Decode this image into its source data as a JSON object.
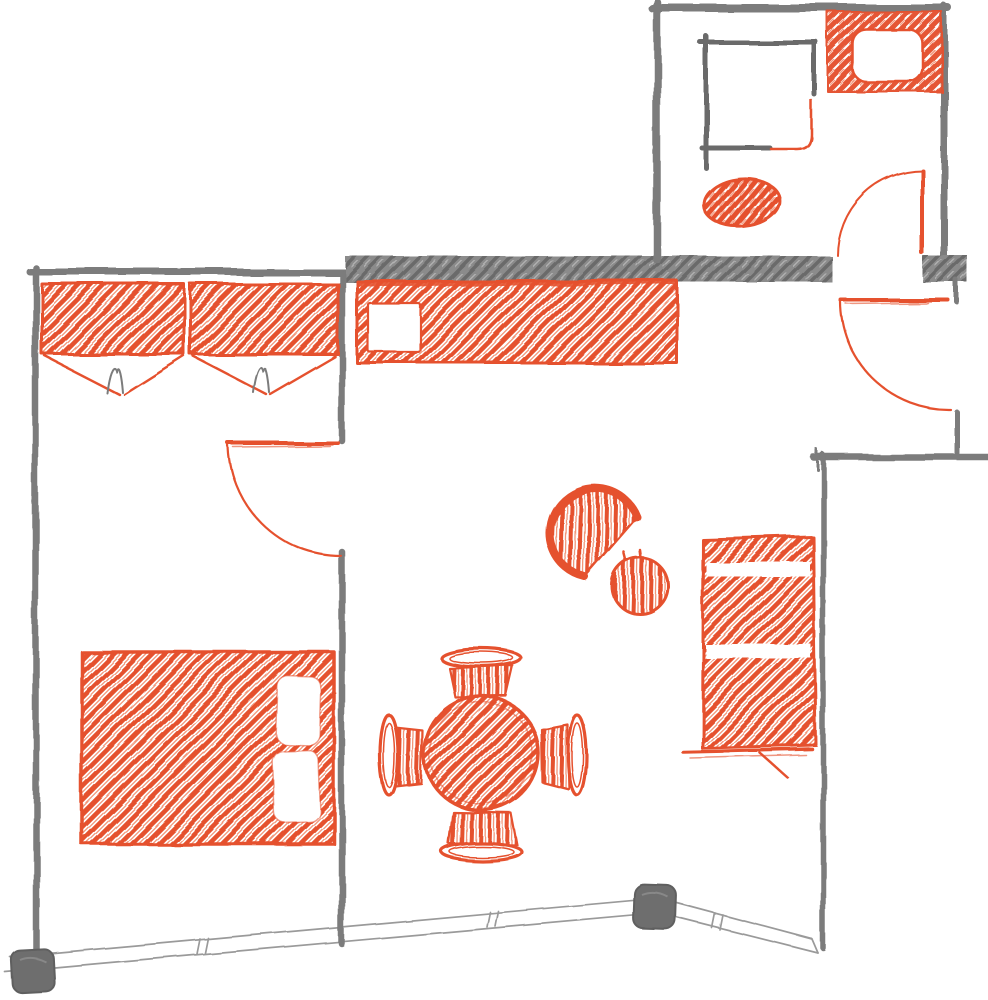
{
  "meta": {
    "title": "Hand-drawn apartment floor plan sketch",
    "style": "sketch, gray walls with orange furniture"
  },
  "palette": {
    "orange": "#e5512e",
    "orange-light": "#f0825f",
    "wall": "#7b7b7b",
    "wall-dark": "#6b6b6b",
    "band": "#8b8b8b",
    "window": "#9a9a9a",
    "post": "#6e6e6e",
    "paper": "#ffffff"
  },
  "scene": {
    "rooms": [
      "bedroom",
      "living-room-with-kitchenette",
      "bathroom",
      "entry-hall"
    ],
    "architecture": [
      "exterior-walls",
      "interior-partition",
      "thick-hatched-wall-band",
      "three-door-swings",
      "panoramic-window-band",
      "two-structural-posts"
    ],
    "furniture": [
      "wardrobe-left-with-open-doors-and-hanger",
      "wardrobe-right-with-open-doors-and-hanger",
      "kitchen-counter-with-sink",
      "shower-enclosure-with-curved-screen",
      "toilet",
      "washbasin-counter",
      "double-bed-with-two-pillows",
      "round-dining-table",
      "dining-chair-north",
      "dining-chair-south",
      "dining-chair-west",
      "dining-chair-east",
      "armchair",
      "round-side-table",
      "two-seat-sofa"
    ]
  }
}
